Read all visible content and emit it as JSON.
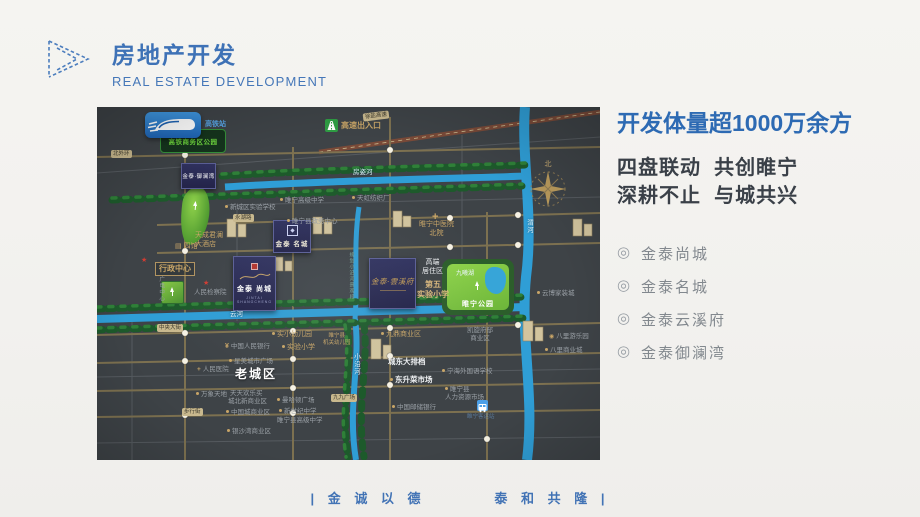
{
  "header": {
    "title": "房地产开发",
    "subtitle": "REAL ESTATE DEVELOPMENT"
  },
  "panel": {
    "headline": "开发体量超1000万余方",
    "slogan1": "四盘联动  共创睢宁",
    "slogan2": "深耕不止  与城共兴",
    "projects": [
      {
        "t": "金泰尚城"
      },
      {
        "t": "金泰名城"
      },
      {
        "t": "金泰云溪府"
      },
      {
        "t": "金泰御澜湾"
      }
    ]
  },
  "footer": {
    "motto": "| 金 诚 以 德        泰 和 共 隆 |"
  },
  "colors": {
    "accent_blue": "#2d6ab3",
    "map_bg": "#3e4347",
    "gold_label": "#c8a567",
    "river_blue": "#2f9ed6",
    "park_green": "#86c943",
    "project_navy": "#2b2d55",
    "badge_green": "#2f9e44",
    "badge_blue": "#2f86d6"
  },
  "map": {
    "hsr_park": "高铁商务区公园",
    "compass_north": "北",
    "boxes": {
      "yulanwan": "金泰·御澜湾",
      "mingcheng": "金泰 名城",
      "shangcheng": "金泰 尚城",
      "shangcheng_sub": "JINTAI SHANGCHENG",
      "yunxifu": "金泰·雲溪府"
    },
    "park": {
      "lake": "九曦湖",
      "name": "睢宁公园"
    },
    "labels": [
      {
        "t": "高铁站",
        "x": 108,
        "y": 13,
        "c": "blue-sm"
      },
      {
        "t": "徐盐高速",
        "x": 266,
        "y": 5,
        "c": "pill rot7"
      },
      {
        "t": "北外环",
        "x": 14,
        "y": 43,
        "c": "pill"
      },
      {
        "t": "高速出入口",
        "x": 244,
        "y": 14,
        "c": "g bold8"
      },
      {
        "t": "睢宁高级中学",
        "x": 183,
        "y": 90,
        "c": "gr dot"
      },
      {
        "t": "新城区实验学校",
        "x": 128,
        "y": 97,
        "c": "gr dot"
      },
      {
        "t": "天虹纺织厂",
        "x": 255,
        "y": 88,
        "c": "gr dot"
      },
      {
        "t": "永湖路",
        "x": 136,
        "y": 107,
        "c": "pill"
      },
      {
        "t": "睢宁县政务中心",
        "x": 190,
        "y": 111,
        "c": "gr dot"
      },
      {
        "t": "四馆",
        "x": 78,
        "y": 135,
        "c": "g icon-bldg"
      },
      {
        "t": "天成君澜\n大酒店",
        "x": 98,
        "y": 124,
        "c": "g"
      },
      {
        "t": "行政中心",
        "x": 58,
        "y": 155,
        "c": "g boxed bold8"
      },
      {
        "t": "★",
        "x": 44,
        "y": 149,
        "c": "star"
      },
      {
        "t": "★",
        "x": 106,
        "y": 172,
        "c": "star"
      },
      {
        "t": "广电中心",
        "x": 60,
        "y": 169,
        "c": "gr vert tiny"
      },
      {
        "t": "人民检察院",
        "x": 97,
        "y": 182,
        "c": "gr"
      },
      {
        "t": "+",
        "x": 335,
        "y": 103,
        "c": "crossicon"
      },
      {
        "t": "睢宁中医院\n北院",
        "x": 322,
        "y": 113,
        "c": "g center"
      },
      {
        "t": "高端\n居住区",
        "x": 325,
        "y": 151,
        "c": "w center"
      },
      {
        "t": "第五\n实验小学",
        "x": 320,
        "y": 173,
        "c": "tb center"
      },
      {
        "t": "房姿河",
        "x": 256,
        "y": 62,
        "c": "riv"
      },
      {
        "t": "渭河",
        "x": 427,
        "y": 112,
        "c": "riv vert"
      },
      {
        "t": "云河",
        "x": 133,
        "y": 204,
        "c": "riv"
      },
      {
        "t": "规划小沿河景观段",
        "x": 251,
        "y": 145,
        "c": "teal vert"
      },
      {
        "t": "中央大街",
        "x": 60,
        "y": 217,
        "c": "pill"
      },
      {
        "t": "中国人民银行",
        "x": 128,
        "y": 235,
        "c": "gr yen"
      },
      {
        "t": "星美城市广场",
        "x": 132,
        "y": 251,
        "c": "gr dot"
      },
      {
        "t": "人民医院",
        "x": 100,
        "y": 259,
        "c": "gr crossb"
      },
      {
        "t": "老城区",
        "x": 138,
        "y": 260,
        "c": "wb"
      },
      {
        "t": "实小幼儿园",
        "x": 175,
        "y": 223,
        "c": "g dot"
      },
      {
        "t": "实验小学",
        "x": 185,
        "y": 236,
        "c": "g dot"
      },
      {
        "t": "睢宁县\n机关幼儿园",
        "x": 226,
        "y": 226,
        "c": "g tiny center"
      },
      {
        "t": "小沿河",
        "x": 254,
        "y": 246,
        "c": "riv vert"
      },
      {
        "t": "九鼎商业区",
        "x": 284,
        "y": 223,
        "c": "g dot"
      },
      {
        "t": "城东大排档",
        "x": 291,
        "y": 250,
        "c": "w bold7"
      },
      {
        "t": "东升菜市场",
        "x": 293,
        "y": 268,
        "c": "w bold7 dot"
      },
      {
        "t": "中国邮储银行",
        "x": 295,
        "y": 297,
        "c": "gr dot"
      },
      {
        "t": "万象天地",
        "x": 99,
        "y": 284,
        "c": "gr dot"
      },
      {
        "t": "天天欢乐买",
        "x": 133,
        "y": 283,
        "c": "gr"
      },
      {
        "t": "城北新商业区",
        "x": 131,
        "y": 291,
        "c": "gr"
      },
      {
        "t": "步行街",
        "x": 85,
        "y": 301,
        "c": "pill"
      },
      {
        "t": "中国城商业区",
        "x": 129,
        "y": 302,
        "c": "gr dot"
      },
      {
        "t": "曼哈顿广场",
        "x": 180,
        "y": 290,
        "c": "gr dot"
      },
      {
        "t": "新世纪中学",
        "x": 182,
        "y": 301,
        "c": "gr dot"
      },
      {
        "t": "睢宁县高级中学",
        "x": 180,
        "y": 310,
        "c": "gr"
      },
      {
        "t": "九九广场",
        "x": 234,
        "y": 287,
        "c": "pill"
      },
      {
        "t": "银沙湾商业区",
        "x": 130,
        "y": 321,
        "c": "gr dot"
      },
      {
        "t": "云博家装城",
        "x": 440,
        "y": 183,
        "c": "gr dot"
      },
      {
        "t": "八里游乐园",
        "x": 452,
        "y": 226,
        "c": "gr wheel"
      },
      {
        "t": "八里商业城",
        "x": 448,
        "y": 240,
        "c": "gr dot"
      },
      {
        "t": "凯旋府邸\n商业区",
        "x": 370,
        "y": 220,
        "c": "gr center"
      },
      {
        "t": "宁海外国语学校",
        "x": 345,
        "y": 261,
        "c": "gr dot"
      },
      {
        "t": "睢宁县\n人力资源市场",
        "x": 348,
        "y": 279,
        "c": "gr dot"
      },
      {
        "t": "睢宁客运站",
        "x": 370,
        "y": 307,
        "c": "blue-faint"
      }
    ]
  }
}
